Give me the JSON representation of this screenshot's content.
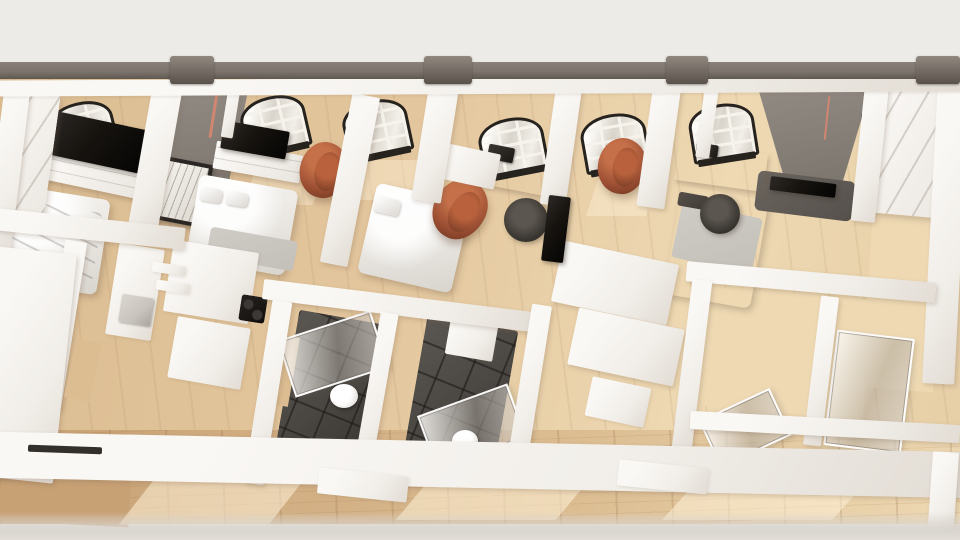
{
  "scene": {
    "description": "Bird's-eye dollhouse 3D architectural rendering of a row of small apartment units with white cut walls, wood floors, arched windows, beds, copper egg chairs, desks, kitchens and dark-tiled bathrooms",
    "view": "top-down cutaway",
    "style": "photorealistic architectural render",
    "visible_text": ""
  },
  "objects": [
    {
      "name": "exterior-wall-band",
      "count": 1
    },
    {
      "name": "wall-pilaster-tab",
      "count": 4
    },
    {
      "name": "arched-window",
      "count": 7
    },
    {
      "name": "tv-screen",
      "count": 4
    },
    {
      "name": "media-console",
      "count": 2
    },
    {
      "name": "bed",
      "count": 4
    },
    {
      "name": "copper-egg-chair",
      "count": 3
    },
    {
      "name": "desk",
      "count": 2
    },
    {
      "name": "office-chair",
      "count": 2
    },
    {
      "name": "kitchen-unit",
      "count": 1
    },
    {
      "name": "cooktop",
      "count": 1
    },
    {
      "name": "dark-tile-bathroom",
      "count": 2
    },
    {
      "name": "shower-glass-panel",
      "count": 4
    },
    {
      "name": "toilet",
      "count": 2
    },
    {
      "name": "wardrobe",
      "count": 2
    },
    {
      "name": "framed-picture",
      "count": 1
    }
  ],
  "colors": {
    "backdrop": "#edebe8",
    "band": "#7d756d",
    "band_edge": "#5f5851",
    "band_tab": "#6b635b",
    "wall_white": "#faf8f5",
    "wall_shade": "#e2dcd4",
    "wall_gray": "#948d86",
    "wall_gray_dark": "#756f68",
    "wall_charcoal": "#55504b",
    "wood": "#dcbd92",
    "wood_light": "#eed9b3",
    "wood_dark": "#c7a074",
    "window_frame": "#26221e",
    "muntin": "#f6f3ed",
    "pane": "#d9d4cb",
    "tv": "#16130f",
    "copper": "#9c4f33",
    "copper_light": "#c57049",
    "copper_dark": "#6e3620",
    "bed_white": "#f6f4f0",
    "bed_gray": "#c3bfb9",
    "pillow_dark": "#3f3b36",
    "tile": "#4a4642",
    "steel": "#c9c4bd",
    "accent_red": "#d08670",
    "slot_dark": "#332f2b",
    "bottom_band": "#d9d4ce",
    "sun": "#fff3d9"
  }
}
